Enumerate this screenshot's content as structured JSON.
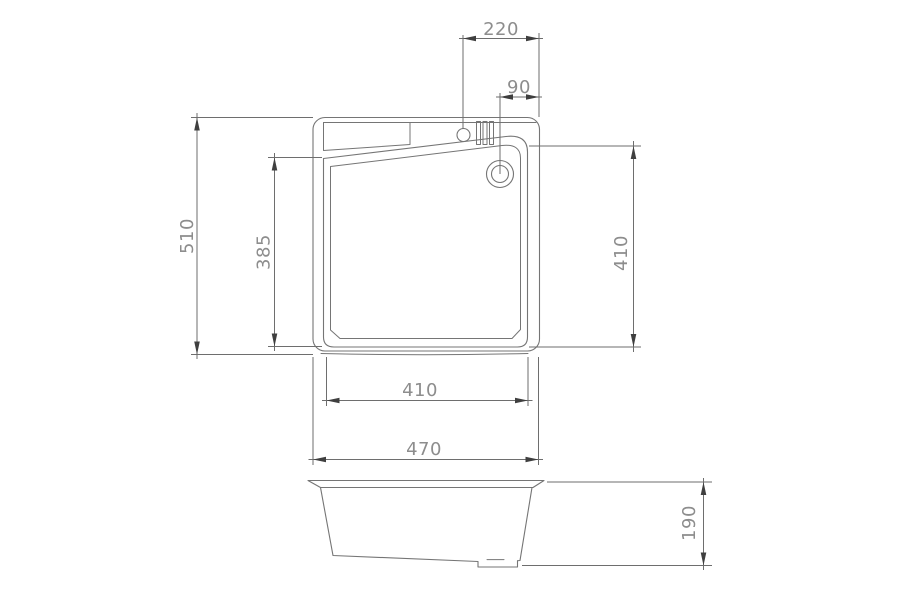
{
  "drawing": {
    "type": "technical-dimension-drawing",
    "subject": "kitchen sink plan and side elevation",
    "dimensions": {
      "faucet_offset_220": "220",
      "drain_offset_90": "90",
      "overall_depth_510": "510",
      "bowl_depth_385": "385",
      "bowl_side_410": "410",
      "bowl_width_410": "410",
      "overall_width_470": "470",
      "body_height_190": "190"
    },
    "colors": {
      "line": "#757575",
      "dim": "#6e6e6e",
      "arrow": "#3f3f3f",
      "label": "#8d8d8d",
      "background": "#ffffff"
    }
  }
}
